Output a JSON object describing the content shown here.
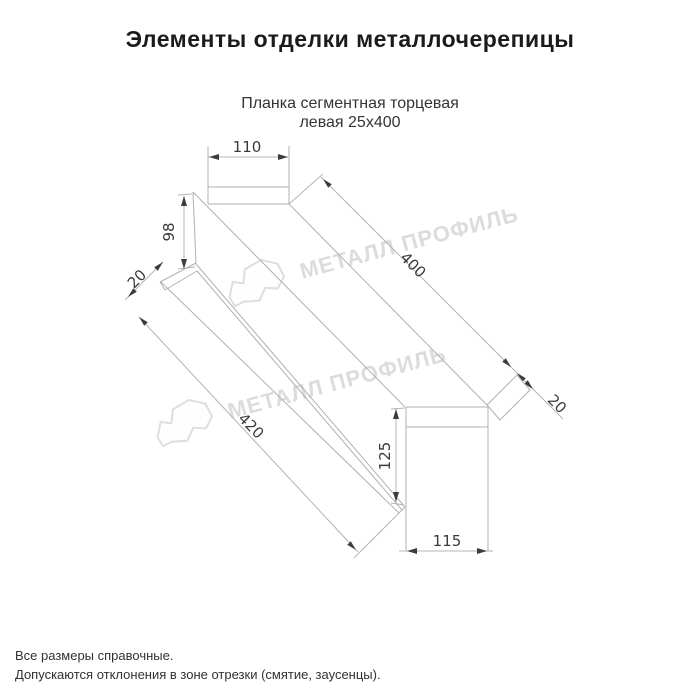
{
  "page": {
    "title": "Элементы отделки металлочерепицы"
  },
  "product": {
    "subtitle_line1": "Планка сегментная торцевая",
    "subtitle_line2": "левая 25х400"
  },
  "dimensions": {
    "top_face_width": "110",
    "left_end_height": "98",
    "left_fold": "20",
    "top_edge_length": "400",
    "bottom_edge_length": "420",
    "right_end_height": "125",
    "right_end_width": "115",
    "right_fold": "20"
  },
  "watermark": {
    "text": "МЕТАЛЛ ПРОФИЛЬ",
    "color": "#dcdcdc"
  },
  "drawing": {
    "line_color": "#b4b4b4",
    "text_color": "#3a3a3a"
  },
  "footer": {
    "line1": "Все размеры справочные.",
    "line2": "Допускаются отклонения в зоне отрезки (смятие, заусенцы)."
  }
}
